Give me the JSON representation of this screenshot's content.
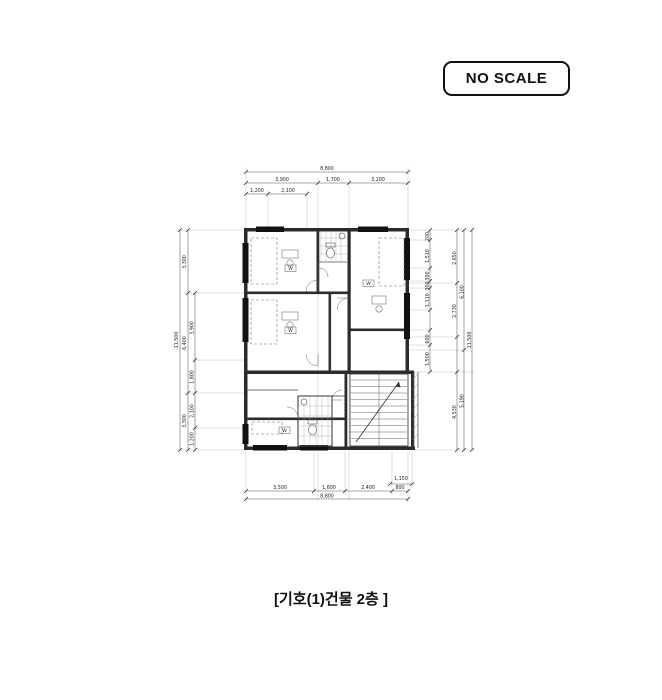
{
  "page": {
    "background": "#ffffff",
    "drawing_line_color": "#1a1a1a",
    "dimension_line_color": "#555555"
  },
  "badge": {
    "label": "NO SCALE"
  },
  "caption": {
    "text": "[기호(1)건물 2층 ]"
  },
  "floor_plan": {
    "room_labels": {
      "wardrobe_1": "W",
      "wardrobe_2": "W",
      "wardrobe_3": "W",
      "wardrobe_4": "W"
    },
    "dimensions": {
      "top": {
        "total": "8,800",
        "row2": [
          "3,900",
          "1,700",
          "3,200"
        ],
        "row3": [
          "1,200",
          "2,100"
        ]
      },
      "bottom": {
        "total": "8,800",
        "segments": [
          "3,500",
          "1,600",
          "2,400",
          "800"
        ],
        "stair_width": "1,150"
      },
      "left": {
        "total": "11,500",
        "col_mid": [
          "3,300",
          "6,400",
          "3,300"
        ],
        "col_inner": [
          "3,900",
          "1,800",
          "2,100",
          "1,200"
        ]
      },
      "right": {
        "total": "11,500",
        "col_mid": [
          "2,650",
          "2,730",
          "4,530"
        ],
        "col_outer_mid": [
          "6,100",
          "5,190"
        ],
        "col_inner": [
          "200",
          "1,510",
          "300",
          "300",
          "1,110",
          "600",
          "1,500"
        ]
      }
    }
  }
}
